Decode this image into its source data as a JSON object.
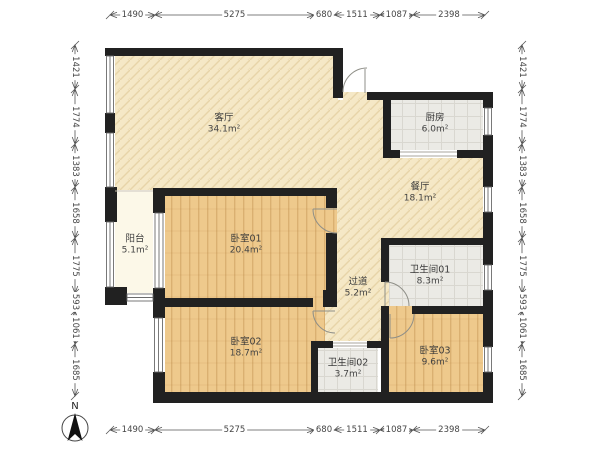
{
  "compass": {
    "north_label": "N"
  },
  "rooms": [
    {
      "name": "客厅",
      "area": "34.1m²"
    },
    {
      "name": "厨房",
      "area": "6.0m²"
    },
    {
      "name": "餐厅",
      "area": "18.1m²"
    },
    {
      "name": "阳台",
      "area": "5.1m²"
    },
    {
      "name": "卧室01",
      "area": "20.4m²"
    },
    {
      "name": "过道",
      "area": "5.2m²"
    },
    {
      "name": "卫生间01",
      "area": "8.3m²"
    },
    {
      "name": "卧室02",
      "area": "18.7m²"
    },
    {
      "name": "卫生间02",
      "area": "3.7m²"
    },
    {
      "name": "卧室03",
      "area": "9.6m²"
    }
  ],
  "dimensions": {
    "top": [
      "1490",
      "5275",
      "680",
      "1511",
      "1087",
      "2398"
    ],
    "bottom": [
      "1490",
      "5275",
      "680",
      "1511",
      "1087",
      "2398"
    ],
    "left": [
      "1421",
      "1774",
      "1383",
      "1658",
      "1775",
      "593",
      "1061",
      "1685"
    ],
    "right": [
      "1421",
      "1774",
      "1383",
      "1658",
      "1775",
      "593",
      "1061",
      "1685"
    ]
  },
  "colors": {
    "wall": "#212121",
    "wood_floor": "#eec98c",
    "tile_floor": "#ebeae5",
    "living_floor": "#f5e8c6",
    "balcony_floor": "#fcf8e8"
  }
}
